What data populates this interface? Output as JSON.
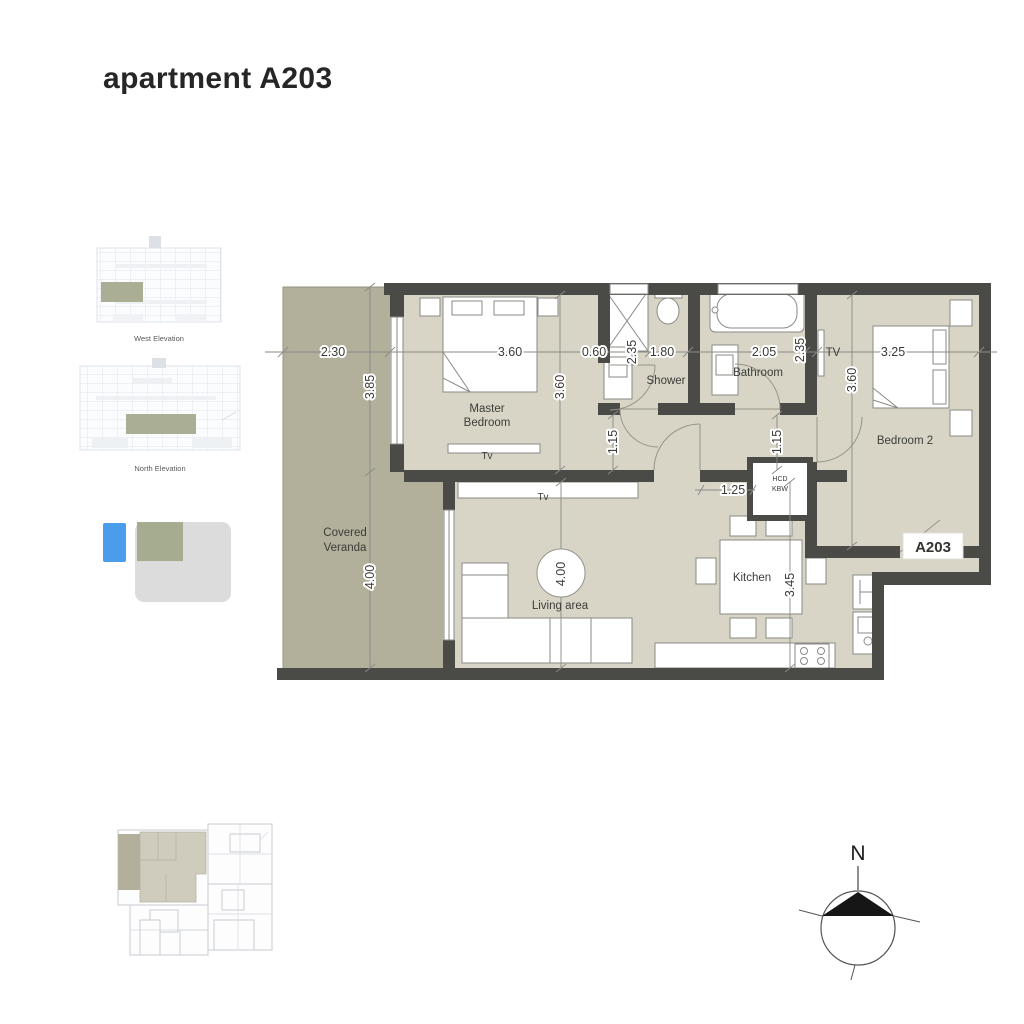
{
  "title": "apartment A203",
  "unit_badge": "A203",
  "north_label": "N",
  "elevations": {
    "west": "West Elevation",
    "north": "North Elevation"
  },
  "colors": {
    "wall": "#4a4a47",
    "room_fill": "#d8d5c7",
    "veranda_fill": "#b2af9b",
    "legend_blue": "#4a9deb",
    "legend_olive": "#a6ac90",
    "legend_gray": "#dcdcdc"
  },
  "rooms": {
    "master_l1": "Master",
    "master_l2": "Bedroom",
    "shower": "Shower",
    "bathroom": "Bathroom",
    "bedroom2": "Bedroom 2",
    "veranda_l1": "Covered",
    "veranda_l2": "Veranda",
    "living": "Living area",
    "kitchen": "Kitchen"
  },
  "fixtures": {
    "tv_master": "Tv",
    "tv_living": "Tv",
    "tv_bedroom2": "TV",
    "closet_l1": "HCD",
    "closet_l2": "KBW"
  },
  "dims": {
    "veranda_w": "2.30",
    "master_w": "3.60",
    "nook": "0.60",
    "wardrobe_d": "2.35",
    "shower_w": "1.80",
    "bath_w": "2.05",
    "bath_d": "2.35",
    "bed2_w": "3.25",
    "veranda_h1": "3.85",
    "master_h": "3.60",
    "hall1": "1.15",
    "hall2": "1.15",
    "bed2_h": "3.60",
    "veranda_h2": "4.00",
    "living_h": "4.00",
    "kitchen_h": "3.45",
    "entry_w": "1.25"
  }
}
